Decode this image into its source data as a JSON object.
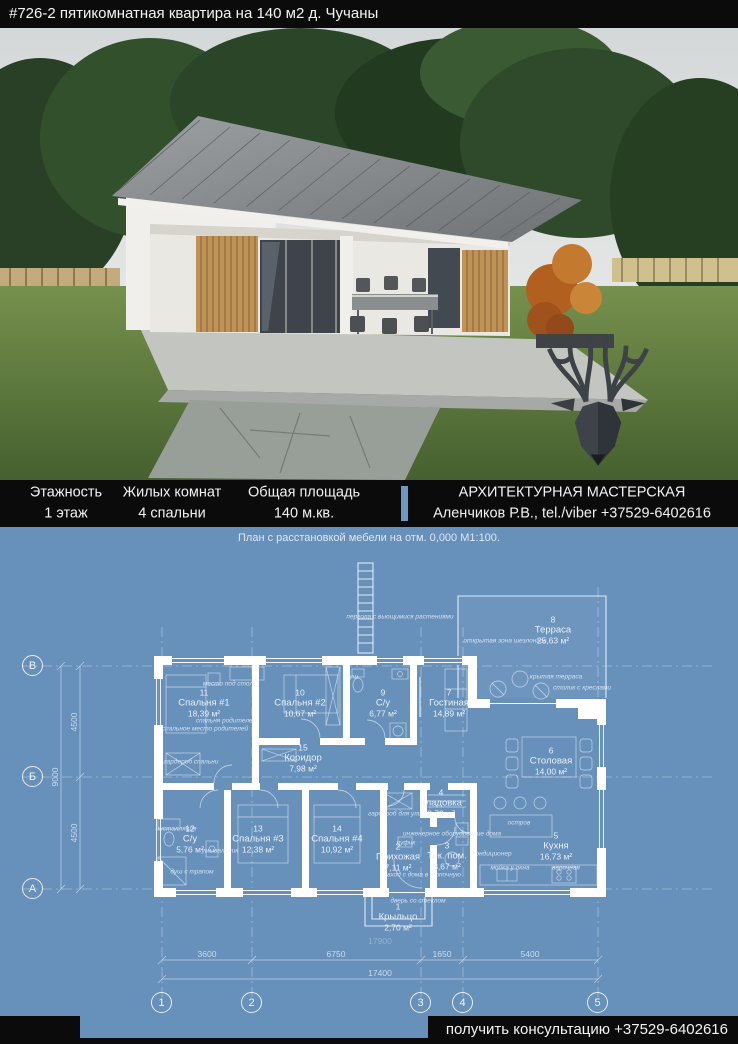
{
  "header": {
    "title": "#726-2 пятикомнатная квартира на 140 м2 д. Чучаны"
  },
  "photo": {
    "logo": "deer-antlers-logo"
  },
  "info_bar": {
    "stats": [
      {
        "label": "Этажность",
        "value": "1 этаж"
      },
      {
        "label": "Жилых комнат",
        "value": "4 спальни"
      },
      {
        "label": "Общая площадь",
        "value": "140 м.кв."
      }
    ],
    "studio_name": "АРХИТЕКТУРНАЯ МАСТЕРСКАЯ",
    "studio_contact": "Аленчиков Р.В., tel./viber +37529-6402616"
  },
  "plan": {
    "caption": "План с расстановкой мебели на отм. 0,000 М1:100.",
    "labels": {
      "rooms": [
        {
          "num": "11",
          "name": "Спальня #1",
          "area": "18,39 м²",
          "x": 204,
          "y": 176
        },
        {
          "num": "10",
          "name": "Спальня #2",
          "area": "10,67 м²",
          "x": 300,
          "y": 176
        },
        {
          "num": "9",
          "name": "С/у",
          "area": "6,77 м²",
          "x": 383,
          "y": 176
        },
        {
          "num": "7",
          "name": "Гостиная",
          "area": "14,89 м²",
          "x": 449,
          "y": 176
        },
        {
          "num": "8",
          "name": "Терраса",
          "area": "25,63 м²",
          "x": 553,
          "y": 103
        },
        {
          "num": "15",
          "name": "Коридор",
          "area": "7,98 м²",
          "x": 303,
          "y": 231
        },
        {
          "num": "6",
          "name": "Столовая",
          "area": "14,00 м²",
          "x": 551,
          "y": 234
        },
        {
          "num": "12",
          "name": "С/у",
          "area": "5,76 м²",
          "x": 190,
          "y": 312
        },
        {
          "num": "13",
          "name": "Спальня #3",
          "area": "12,38 м²",
          "x": 258,
          "y": 312
        },
        {
          "num": "14",
          "name": "Спальня #4",
          "area": "10,92 м²",
          "x": 337,
          "y": 312
        },
        {
          "num": "2",
          "name": "Прихожая",
          "area": "7,11 м²",
          "x": 398,
          "y": 330
        },
        {
          "num": "3",
          "name": "Тек. пом.",
          "area": "3,67 м²",
          "x": 447,
          "y": 329
        },
        {
          "num": "4",
          "name": "Кладовка",
          "area": "2,73 м²",
          "x": 441,
          "y": 276
        },
        {
          "num": "5",
          "name": "Кухня",
          "area": "16,73 м²",
          "x": 556,
          "y": 319
        },
        {
          "num": "1",
          "name": "Крыльцо",
          "area": "2,70 м²",
          "x": 398,
          "y": 390
        }
      ],
      "annotations": [
        {
          "text": "пергола с вьющимися растениями",
          "x": 400,
          "y": 90
        },
        {
          "text": "открытая зона шезлонгов",
          "x": 505,
          "y": 114
        },
        {
          "text": "крытая терраса",
          "x": 556,
          "y": 150
        },
        {
          "text": "столик с креслами",
          "x": 582,
          "y": 161
        },
        {
          "text": "место под стол",
          "x": 228,
          "y": 157
        },
        {
          "text": "спальня родителей",
          "x": 226,
          "y": 194
        },
        {
          "text": "спальное место родителей",
          "x": 205,
          "y": 202
        },
        {
          "text": "гардероб спальни",
          "x": 191,
          "y": 235
        },
        {
          "text": "душ",
          "x": 352,
          "y": 150
        },
        {
          "text": "инсталляция",
          "x": 176,
          "y": 302
        },
        {
          "text": "умывальник",
          "x": 220,
          "y": 324
        },
        {
          "text": "душ с трапом",
          "x": 192,
          "y": 345
        },
        {
          "text": "гардероб для улицы",
          "x": 399,
          "y": 287
        },
        {
          "text": "пуфик",
          "x": 406,
          "y": 316
        },
        {
          "text": "инженерное оборудование дома",
          "x": 452,
          "y": 307
        },
        {
          "text": "кондиционер",
          "x": 492,
          "y": 327
        },
        {
          "text": "вход с дома в топочную",
          "x": 424,
          "y": 348
        },
        {
          "text": "дверь со стеклом",
          "x": 418,
          "y": 374
        },
        {
          "text": "мойка у окна",
          "x": 510,
          "y": 341
        },
        {
          "text": "варочная",
          "x": 566,
          "y": 341
        },
        {
          "text": "остров",
          "x": 519,
          "y": 296
        }
      ],
      "dimensions": [
        {
          "text": "3600",
          "x": 207,
          "y": 427
        },
        {
          "text": "6750",
          "x": 336,
          "y": 427
        },
        {
          "text": "1650",
          "x": 442,
          "y": 427
        },
        {
          "text": "5400",
          "x": 530,
          "y": 427
        },
        {
          "text": "17400",
          "x": 380,
          "y": 446
        },
        {
          "text": "17900",
          "x": 380,
          "y": 414,
          "faint": true
        },
        {
          "text": "4500",
          "x": 74,
          "y": 195,
          "vertical": true
        },
        {
          "text": "4500",
          "x": 74,
          "y": 306,
          "vertical": true
        },
        {
          "text": "9000",
          "x": 55,
          "y": 250,
          "vertical": true
        }
      ],
      "grid_bubbles": [
        {
          "label": "1",
          "x": 162,
          "y": 476
        },
        {
          "label": "2",
          "x": 252,
          "y": 476
        },
        {
          "label": "3",
          "x": 421,
          "y": 476
        },
        {
          "label": "4",
          "x": 463,
          "y": 476
        },
        {
          "label": "5",
          "x": 598,
          "y": 476
        },
        {
          "label": "В",
          "x": 33,
          "y": 139
        },
        {
          "label": "Б",
          "x": 33,
          "y": 250
        },
        {
          "label": "А",
          "x": 33,
          "y": 362
        }
      ]
    }
  },
  "footer": {
    "cta": "получить консультацию +37529-6402616"
  },
  "colors": {
    "blueprint_bg": "#6790ba",
    "bar_black": "#0b0b0b",
    "divider_blue": "#6f97c3"
  }
}
